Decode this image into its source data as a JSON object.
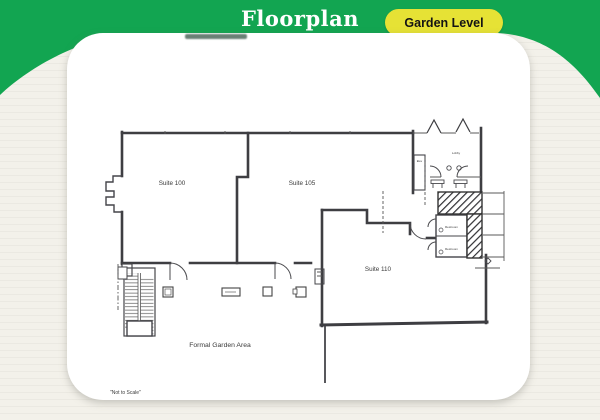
{
  "header": {
    "title": "Floorplan",
    "level_button_label": "Garden Level"
  },
  "floorplan": {
    "suite_100": "Suite 100",
    "suite_105": "Suite 105",
    "suite_110": "Suite 110",
    "garden_area": "Formal Garden Area",
    "scale_note": "\"Not to Scale\"",
    "restroom_upper": "Restroom",
    "restroom_lower": "Restroom",
    "lobby": "Lobby",
    "elevator": "Elev"
  },
  "colors": {
    "header_green": "#12a551",
    "button_yellow": "#e6e235",
    "page_background": "#f3f1ea",
    "card_white": "#ffffff",
    "line_ink": "#3e3e42"
  }
}
